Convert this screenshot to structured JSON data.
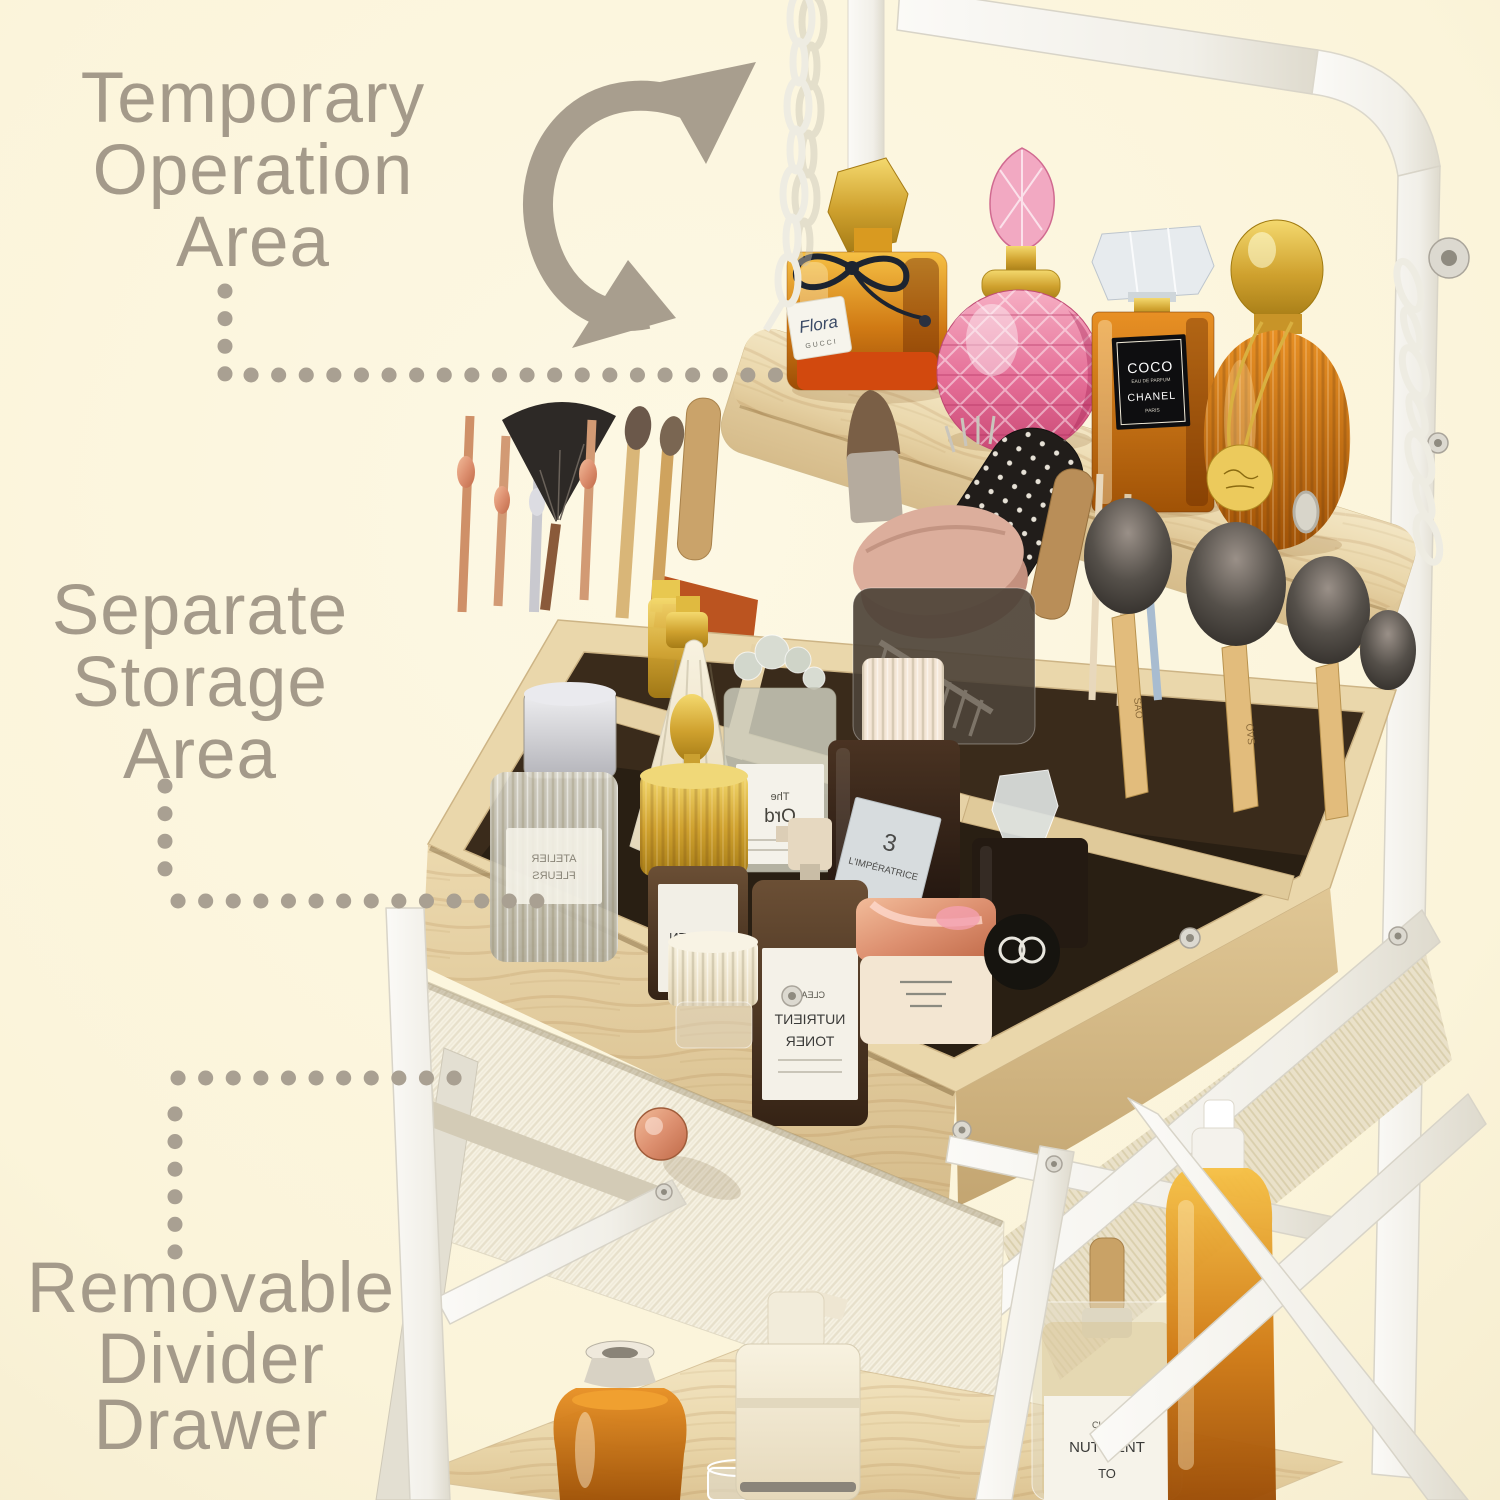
{
  "scene": {
    "type": "annotated-product-infographic",
    "subject": "makeup-organizer-vanity-cart",
    "background_color": "#FBF5DC",
    "annotation_color": "#A49A8A",
    "wood_color": "#EAD7AD",
    "frame_color": "#F6F5F0",
    "amber_color": "#D07A14",
    "pink_color": "#E56E97",
    "rose_gold_color": "#D28660"
  },
  "annotations": {
    "rotation_arrow_direction": "counterclockwise",
    "labels": [
      {
        "name": "temporary-operation-area",
        "lines": [
          "Temporary",
          "Operation",
          "Area"
        ]
      },
      {
        "name": "separate-storage-area",
        "lines": [
          "Separate",
          "Storage",
          "Area"
        ]
      },
      {
        "name": "removable-divider-drawer",
        "lines": [
          "Removable",
          "Divider",
          "Drawer"
        ]
      }
    ]
  },
  "products": {
    "top_shelf": [
      {
        "name": "amber-square-perfume",
        "label_lines": [
          "Flora",
          "GUCCI"
        ]
      },
      {
        "name": "pink-crystal-perfume",
        "label_lines": []
      },
      {
        "name": "amber-rect-perfume",
        "label_lines": [
          "COCO",
          "EAU DE PARFUM",
          "CHANEL",
          "PARIS"
        ]
      },
      {
        "name": "amber-ribbed-perfume",
        "label_lines": []
      }
    ],
    "storage_area": [
      {
        "name": "ribbed-glass-bottle",
        "label_lines": [
          "ATELIER",
          "FLEURS"
        ]
      },
      {
        "name": "clear-serum-bottle",
        "label_lines": [
          "The",
          "Ord"
        ]
      },
      {
        "name": "gold-dropper-bottle",
        "label_lines": [
          "NUTRIEN"
        ]
      },
      {
        "name": "imperatrice-bottle",
        "label_lines": [
          "3",
          "L'IMPÉRATRICE"
        ]
      },
      {
        "name": "toner-spray-bottle",
        "label_lines": [
          "CLEAR",
          "NUTRIENT",
          "TONER"
        ]
      },
      {
        "name": "brush-set",
        "markings": [
          "SAO",
          "OVS",
          "natural"
        ]
      }
    ],
    "bottom_shelf": [
      {
        "name": "clear-pump-bottle",
        "label_lines": [
          "CLEAR",
          "NUTRIENT",
          "TO"
        ]
      }
    ]
  }
}
